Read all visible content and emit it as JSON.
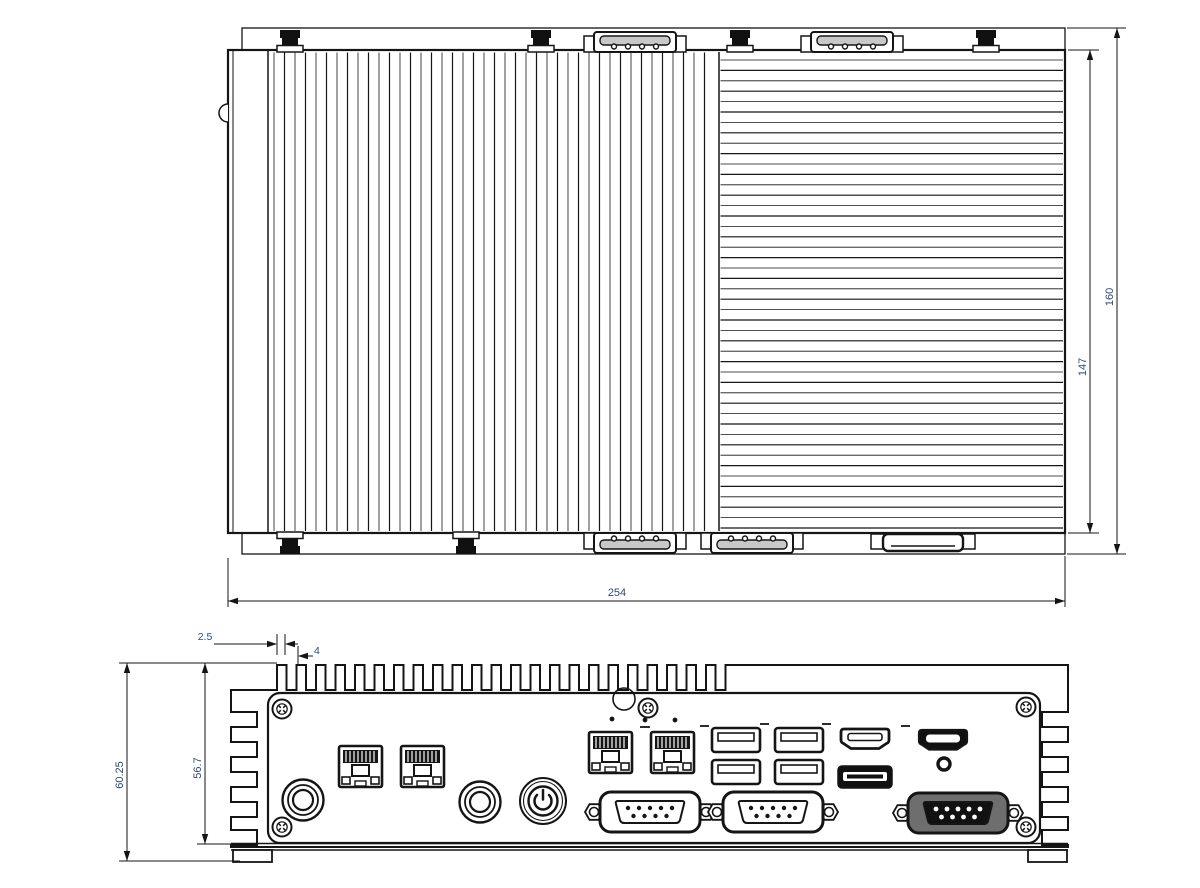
{
  "drawing": {
    "title": "Embedded fanless box PC - dimensional drawing",
    "views": {
      "top": "Top view",
      "front": "Front view"
    },
    "colors": {
      "line": "#151515",
      "dimension_text": "#31487a",
      "background": "#ffffff"
    },
    "dimensions": {
      "overall_width_mm": "254",
      "overall_depth_mm": "160",
      "body_depth_mm": "147",
      "overall_height_mm": "60.25",
      "body_height_mm": "56.7",
      "fin_slot_mm": "2.5",
      "fin_pitch_mm": "4"
    },
    "front_panel_ports": [
      "antenna-hole-1",
      "lan-rj45-1",
      "lan-rj45-2",
      "antenna-hole-2",
      "power-button",
      "lan-rj45-3",
      "lan-rj45-4",
      "usb-port-1",
      "usb-port-2",
      "usb-port-3",
      "usb-port-4",
      "hdmi-port-1",
      "hdmi-port-2",
      "displayport",
      "reset-hole",
      "com-db9-1",
      "com-db9-2",
      "com-db9-3"
    ]
  }
}
